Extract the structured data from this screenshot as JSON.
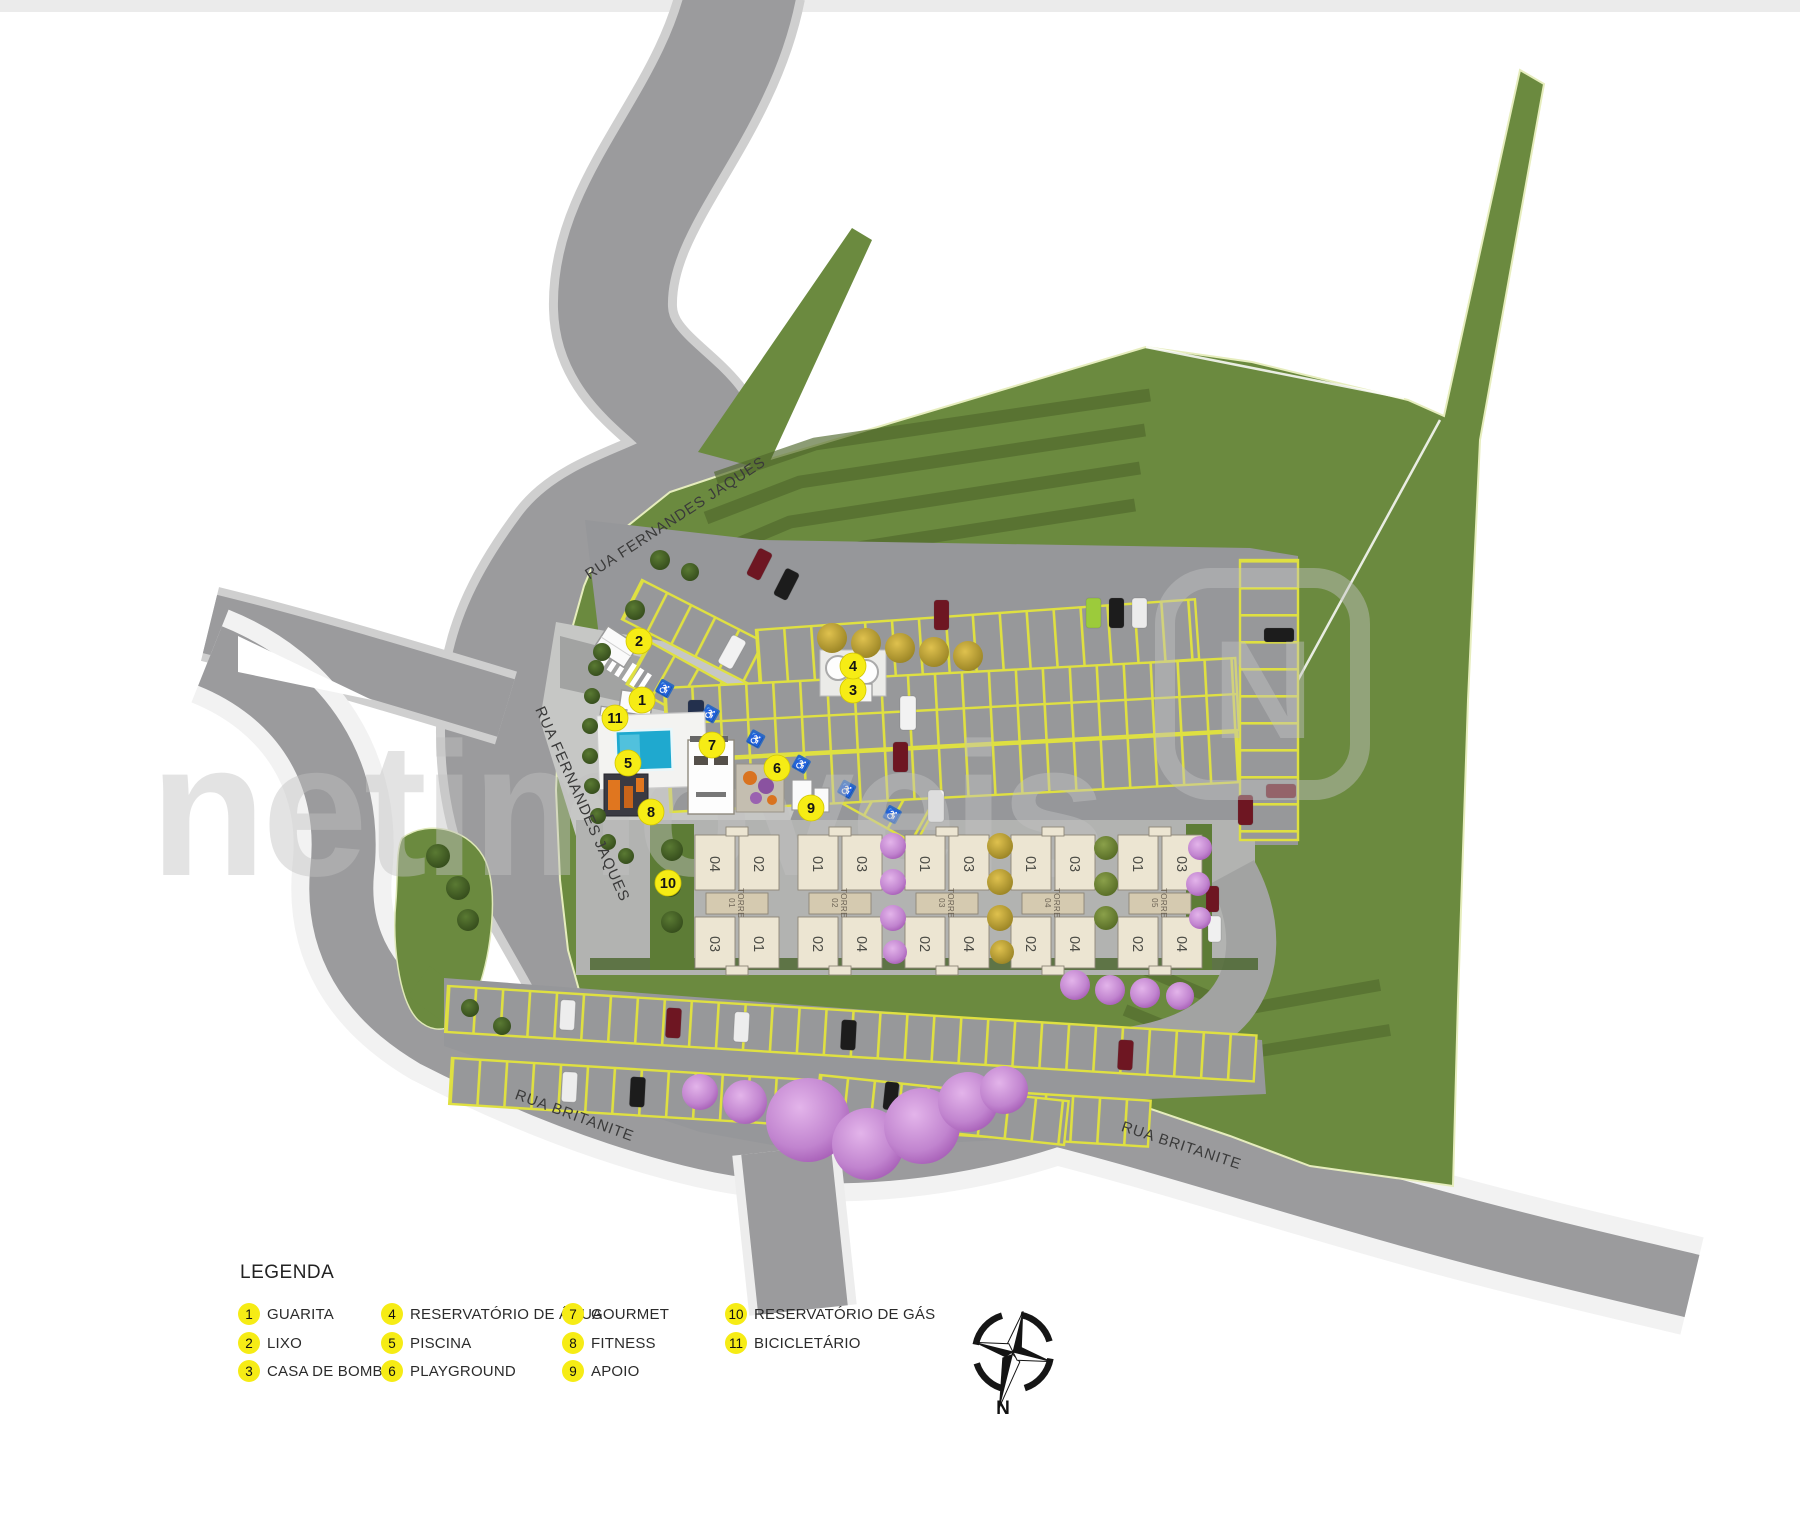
{
  "map": {
    "streets": {
      "fernandes_top": "RUA FERNANDES JAQUES",
      "fernandes_side": "RUA FERNANDES JAQUES",
      "britanite_left": "RUA BRITANITE",
      "britanite_right": "RUA BRITANITE"
    },
    "watermark": {
      "text": "netimóveis",
      "logo_letter": "N"
    },
    "towers": [
      {
        "id": "torre-01",
        "label": "TORRE",
        "num": "01",
        "x": 737,
        "units": [
          "04",
          "02",
          "03",
          "01"
        ]
      },
      {
        "id": "torre-02",
        "label": "TORRE",
        "num": "02",
        "x": 840,
        "units": [
          "01",
          "03",
          "02",
          "04"
        ]
      },
      {
        "id": "torre-03",
        "label": "TORRE",
        "num": "03",
        "x": 947,
        "units": [
          "01",
          "03",
          "02",
          "04"
        ]
      },
      {
        "id": "torre-04",
        "label": "TORRE",
        "num": "04",
        "x": 1053,
        "units": [
          "01",
          "03",
          "02",
          "04"
        ]
      },
      {
        "id": "torre-05",
        "label": "TORRE",
        "num": "05",
        "x": 1160,
        "units": [
          "01",
          "03",
          "02",
          "04"
        ]
      }
    ],
    "markers": [
      {
        "n": "1",
        "x": 642,
        "y": 700
      },
      {
        "n": "2",
        "x": 639,
        "y": 641
      },
      {
        "n": "3",
        "x": 853,
        "y": 690
      },
      {
        "n": "4",
        "x": 853,
        "y": 666
      },
      {
        "n": "5",
        "x": 628,
        "y": 763
      },
      {
        "n": "6",
        "x": 777,
        "y": 768
      },
      {
        "n": "7",
        "x": 712,
        "y": 745
      },
      {
        "n": "8",
        "x": 651,
        "y": 812
      },
      {
        "n": "9",
        "x": 811,
        "y": 808
      },
      {
        "n": "10",
        "x": 668,
        "y": 883
      },
      {
        "n": "11",
        "x": 615,
        "y": 718
      }
    ]
  },
  "legend": {
    "title": "LEGENDA",
    "columns": [
      {
        "items": [
          {
            "n": "1",
            "label": "GUARITA"
          },
          {
            "n": "2",
            "label": "LIXO"
          },
          {
            "n": "3",
            "label": "CASA DE BOMBAS"
          }
        ]
      },
      {
        "items": [
          {
            "n": "4",
            "label": "RESERVATÓRIO DE ÁGUA"
          },
          {
            "n": "5",
            "label": "PISCINA"
          },
          {
            "n": "6",
            "label": "PLAYGROUND"
          }
        ]
      },
      {
        "items": [
          {
            "n": "7",
            "label": "GOURMET"
          },
          {
            "n": "8",
            "label": "FITNESS"
          },
          {
            "n": "9",
            "label": "APOIO"
          }
        ]
      },
      {
        "items": [
          {
            "n": "10",
            "label": "RESERVATÓRIO DE GÁS"
          },
          {
            "n": "11",
            "label": "BICICLETÁRIO"
          }
        ]
      }
    ]
  },
  "compass": {
    "label": "N"
  },
  "colors": {
    "road": "#9b9b9d",
    "road_casing": "#cfcfcf",
    "grass": "#6b8a3f",
    "grass_dark": "#54702f",
    "parking_pad": "#97989a",
    "stall_line": "#dfe041",
    "building": "#ece5d2",
    "building_label": "#d5cab0",
    "pool": "#1fa9cf",
    "marker_yellow": "#f6ec15",
    "watermark_gray": "#c2c2c2"
  }
}
